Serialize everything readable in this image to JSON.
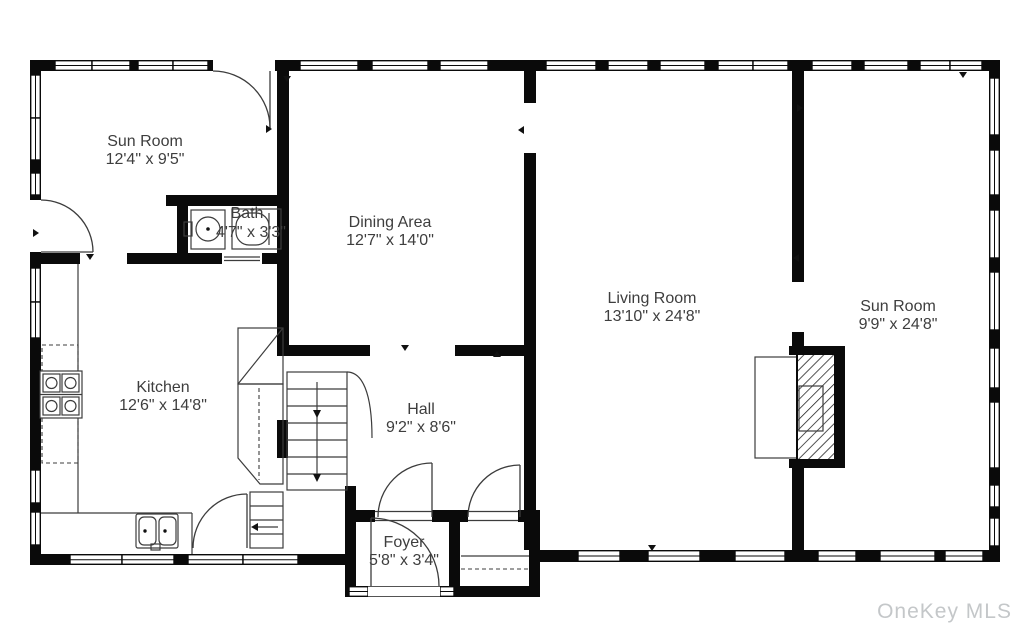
{
  "colors": {
    "wall": "#0a0a0a",
    "line": "#3c3c3c",
    "label": "#3e3e3e",
    "watermark": "#c4c7c9",
    "background": "#ffffff"
  },
  "watermark": {
    "text": "OneKey MLS"
  },
  "rooms": {
    "sun_room_left": {
      "name": "Sun Room",
      "dims": "12'4\" x 9'5\""
    },
    "bath": {
      "name": "Bath",
      "dims": "4'7\" x 3'3\""
    },
    "dining_area": {
      "name": "Dining Area",
      "dims": "12'7\" x 14'0\""
    },
    "living_room": {
      "name": "Living Room",
      "dims": "13'10\" x 24'8\""
    },
    "sun_room_right": {
      "name": "Sun Room",
      "dims": "9'9\" x 24'8\""
    },
    "kitchen": {
      "name": "Kitchen",
      "dims": "12'6\" x 14'8\""
    },
    "hall": {
      "name": "Hall",
      "dims": "9'2\" x 8'6\""
    },
    "foyer": {
      "name": "Foyer",
      "dims": "5'8\" x 3'4\""
    }
  }
}
